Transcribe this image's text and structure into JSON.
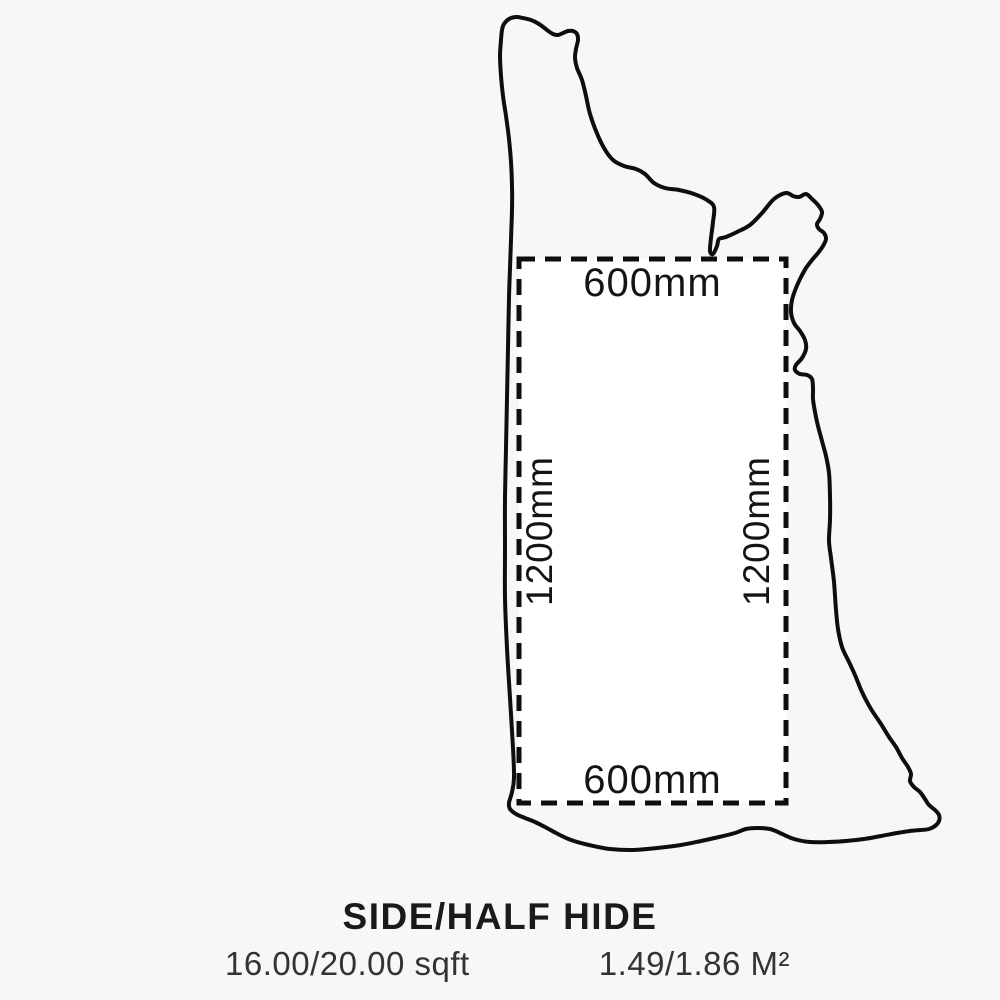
{
  "diagram": {
    "name": "leather-hide-cut-diagram",
    "shape": "side-half-hide-outline",
    "cut_rectangle": {
      "top_label": "600mm",
      "bottom_label": "600mm",
      "left_label": "1200mm",
      "right_label": "1200mm",
      "width_mm": 600,
      "height_mm": 1200
    },
    "colors": {
      "background": "#f7f7f7",
      "outline": "#0e0e0e",
      "rect_fill": "#ffffff",
      "rect_stroke": "#0e0e0e",
      "text": "#1a1a1a"
    }
  },
  "caption": {
    "title": "SIDE/HALF HIDE",
    "area_sqft": "16.00/20.00 sqft",
    "area_m2": "1.49/1.86 M²"
  }
}
